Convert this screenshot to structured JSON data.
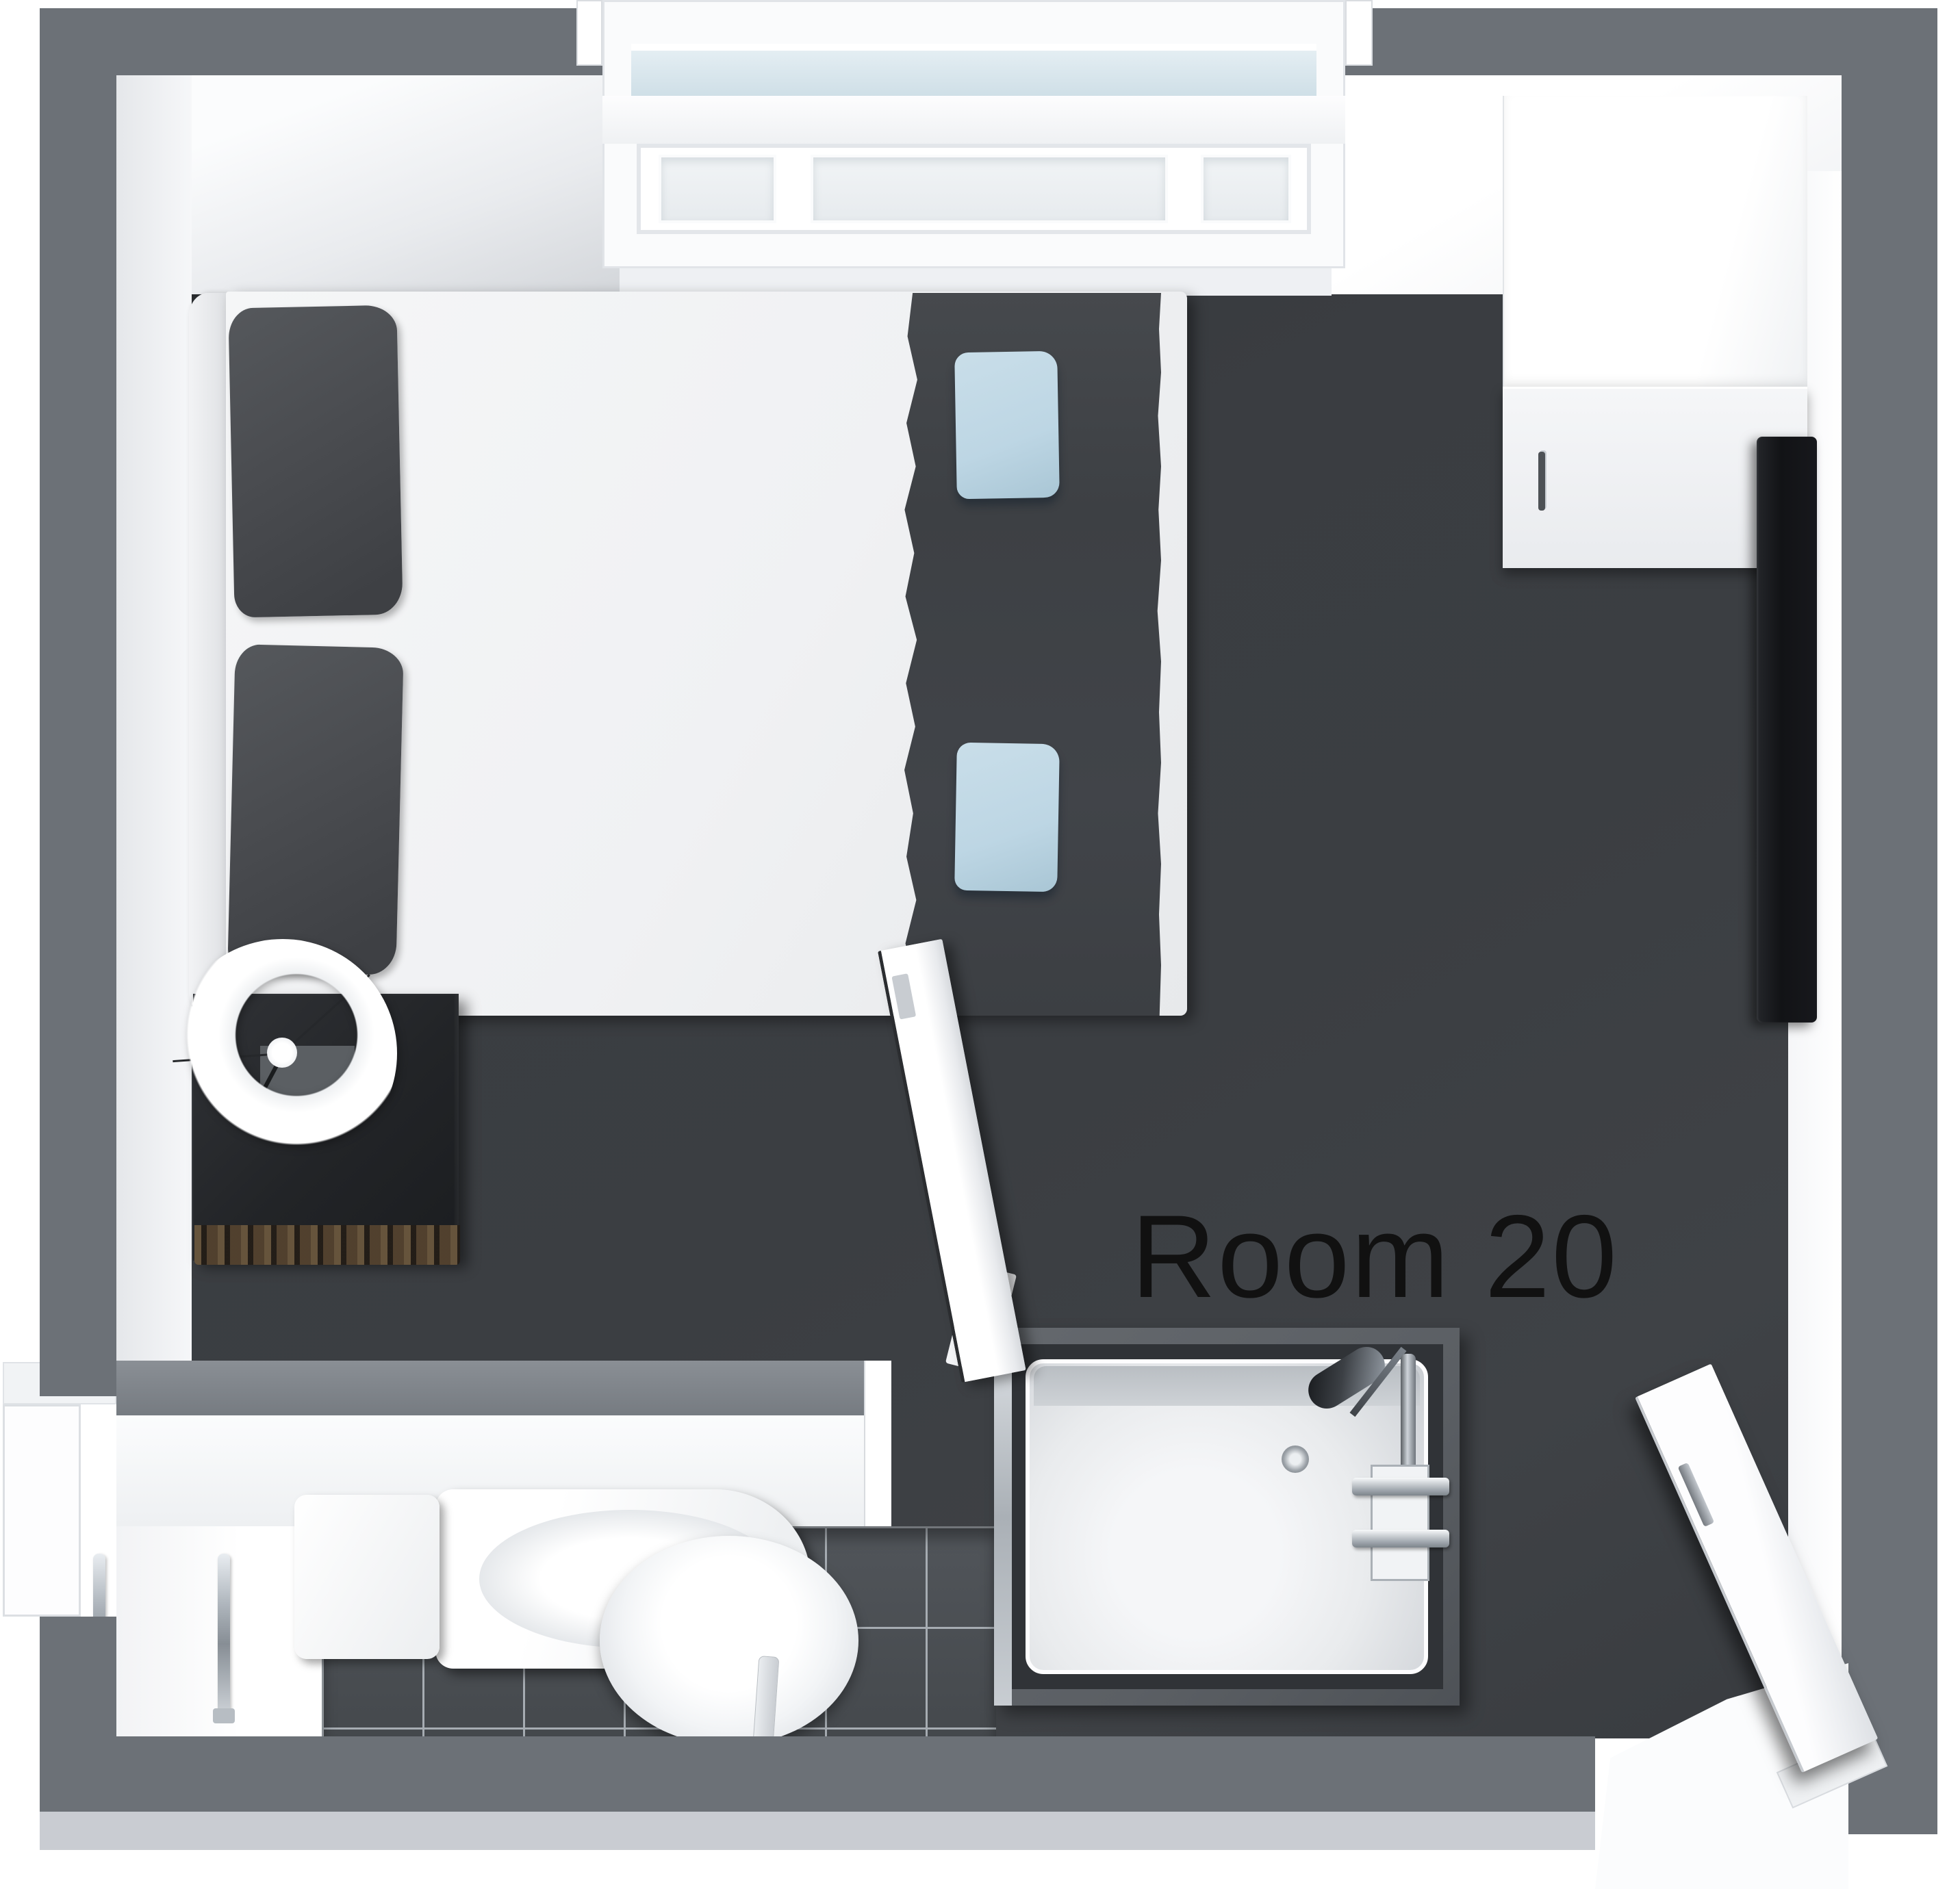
{
  "floorplan": {
    "room_label": "Room 20",
    "colors": {
      "outer_wall": "#6c7177",
      "outer_wall_face": "#c9ccd2",
      "inner_wall": "#f2f3f5",
      "bedroom_floor": "#3b3e42",
      "bathroom_tile": "#4b4f53",
      "tile_grout": "#a6acb2",
      "mattress": "#f0f1f3",
      "duvet": "#414449",
      "head_pillow": "#4a4c50",
      "accent_pillow": "#bdd6e4",
      "nightstand": "#26282b",
      "nightstand_wood": "#3b3127",
      "fixture_white": "#fafbfc",
      "chrome": "#b9bfc6",
      "tv": "#17181b",
      "shower_surround": "#5b5f64",
      "shower_tray": "#e9ebed",
      "label": "#111111"
    },
    "furniture_names": [
      "double-bed",
      "bed-headboard",
      "head-pillows",
      "duvet-runner",
      "accent-pillows",
      "nightstand",
      "table-lamp",
      "wardrobe",
      "tv-screen",
      "bay-window",
      "toilet",
      "washbasin",
      "tap",
      "shower-enclosure",
      "towel-rails",
      "bathroom-door",
      "entry-door"
    ]
  }
}
